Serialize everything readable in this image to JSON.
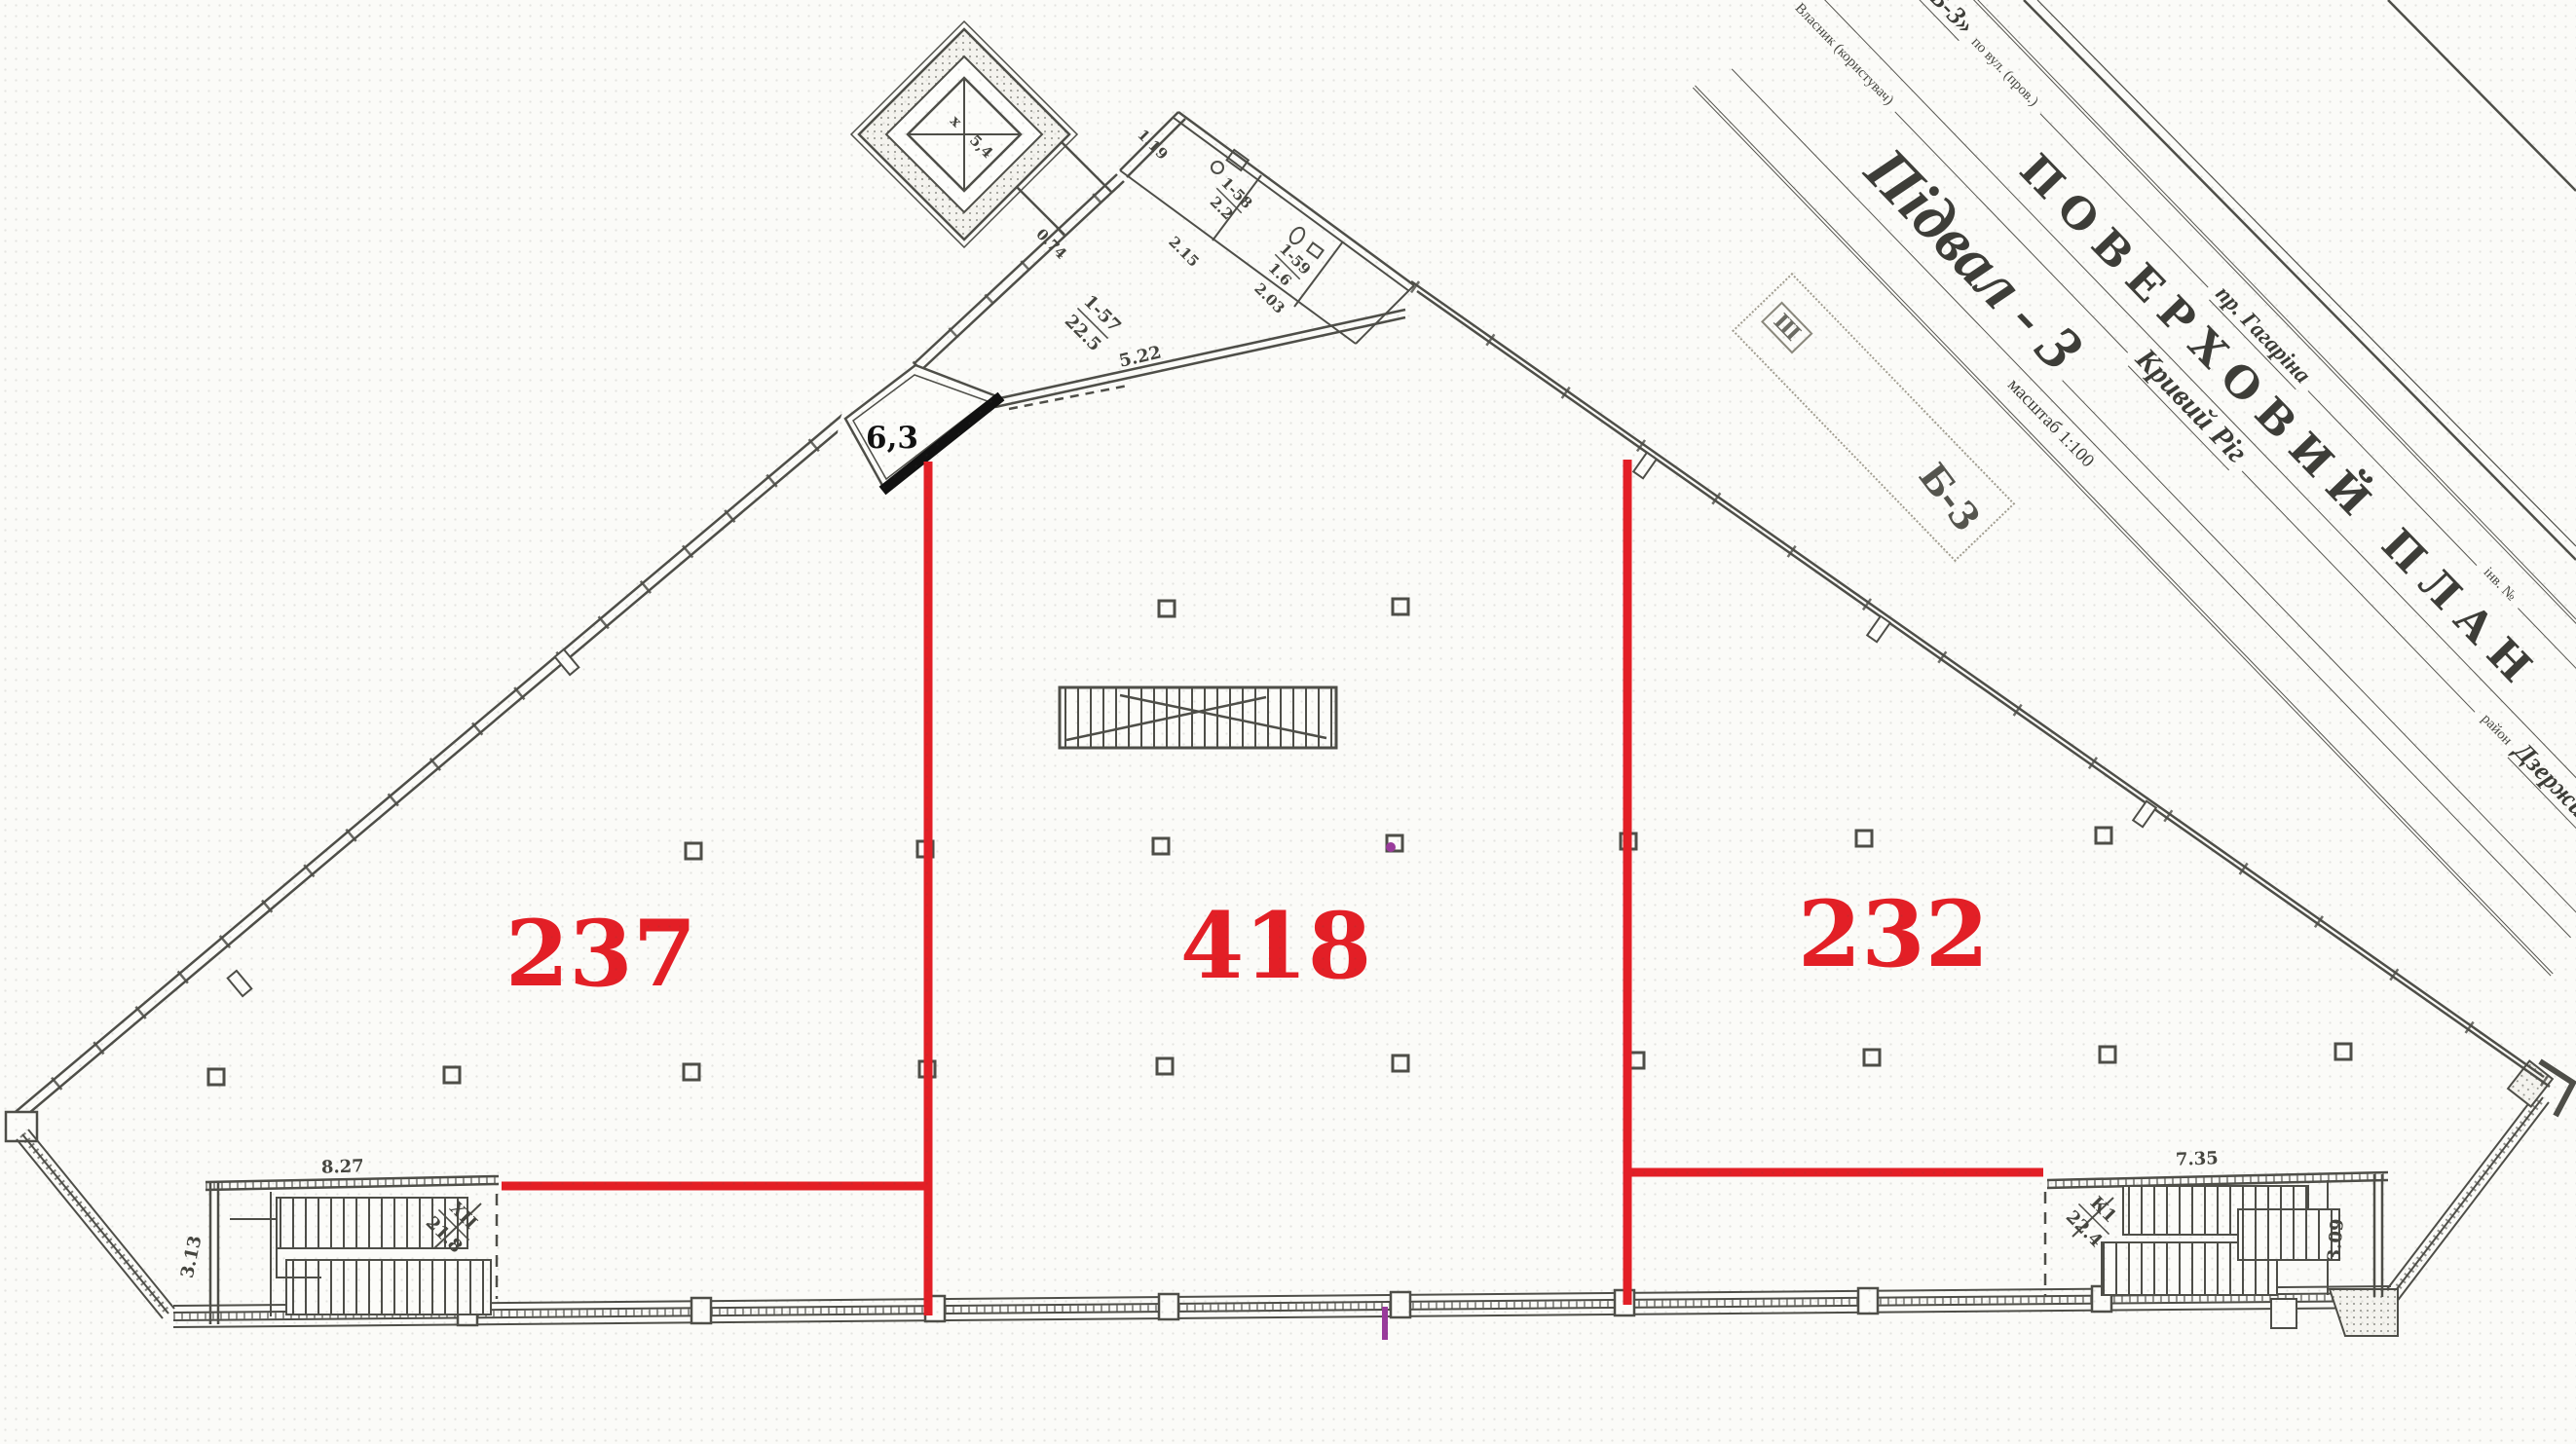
{
  "title_block": {
    "field1_label_a": "дом № літ",
    "field1_value_a": "«Б-3»",
    "field1_label_b": "по вул. (пров.)",
    "field1_value_b": "пр. Гагаріна",
    "field1_label_c": "інв. №",
    "field1_label_d": "На-",
    "title": "ПОВЕРХОВИЙ ПЛАН",
    "owner_label": "Власник (користувач)",
    "city": "Кривий Ріг",
    "district_label": "район",
    "district": "Дзержинський",
    "floor_name": "Підвал - 3",
    "scale": "масштаб 1:100"
  },
  "stamp": {
    "symbol": "Ш",
    "code": "Б-3"
  },
  "zones": {
    "left_area": "237",
    "center_area": "418",
    "right_area": "232"
  },
  "annotations": {
    "room_63": "6,3"
  },
  "labels": {
    "lift_mark": "х",
    "lift_area": "5,4",
    "dim_074": "0.74",
    "dim_119": "1.19",
    "dim_215": "2.15",
    "dim_203": "2.03",
    "dim_522": "5.22",
    "hall_no": "1-57",
    "hall_area": "22.5",
    "room_a_no": "1-58",
    "room_a_area": "2.2",
    "room_b_no": "1-59",
    "room_b_area": "1.6",
    "stair_left_no": "ХІІ",
    "stair_left_area": "21.8",
    "stair_left_w": "8.27",
    "stair_left_d": "3.13",
    "stair_right_no": "К1",
    "stair_right_area": "22.4",
    "stair_right_w": "7.35",
    "stair_right_d": "3.09"
  },
  "colors": {
    "red": "#e31f26",
    "magenta": "#993b9b",
    "highlight": "#111111",
    "ink": "#4e4e48"
  }
}
